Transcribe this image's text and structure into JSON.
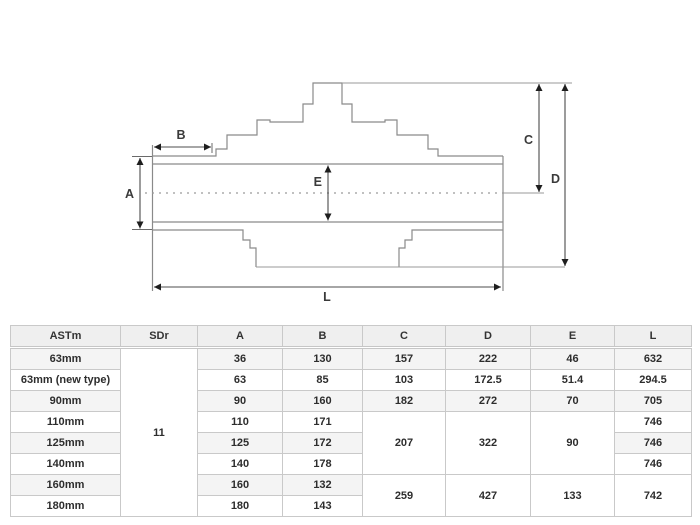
{
  "diagram": {
    "labels": {
      "A": "A",
      "B": "B",
      "C": "C",
      "D": "D",
      "E": "E",
      "L": "L"
    }
  },
  "table": {
    "headers": [
      "ASTm",
      "SDr",
      "A",
      "B",
      "C",
      "D",
      "E",
      "L"
    ],
    "sdr": {
      "value": "11",
      "rowspan": 8
    },
    "rows": [
      {
        "name": "63mm",
        "cells": [
          [
            "36"
          ],
          [
            "130"
          ],
          [
            "157"
          ],
          [
            "222"
          ],
          [
            "46"
          ],
          [
            "632"
          ]
        ]
      },
      {
        "name": "63mm (new type)",
        "cells": [
          [
            "63"
          ],
          [
            "85"
          ],
          [
            "103"
          ],
          [
            "172.5"
          ],
          [
            "51.4"
          ],
          [
            "294.5"
          ]
        ]
      },
      {
        "name": "90mm",
        "cells": [
          [
            "90"
          ],
          [
            "160"
          ],
          [
            "182"
          ],
          [
            "272"
          ],
          [
            "70"
          ],
          [
            "705"
          ]
        ]
      },
      {
        "name": "110mm",
        "cells": [
          [
            "110"
          ],
          [
            "171"
          ],
          [
            "207",
            3
          ],
          [
            "322",
            3
          ],
          [
            "90",
            3
          ],
          [
            "746"
          ]
        ]
      },
      {
        "name": "125mm",
        "cells": [
          [
            "125"
          ],
          [
            "172"
          ],
          [
            "746"
          ]
        ]
      },
      {
        "name": "140mm",
        "cells": [
          [
            "140"
          ],
          [
            "178"
          ],
          [
            "746"
          ]
        ]
      },
      {
        "name": "160mm",
        "cells": [
          [
            "160"
          ],
          [
            "132"
          ],
          [
            "259",
            2
          ],
          [
            "427",
            2
          ],
          [
            "133",
            2
          ],
          [
            "742",
            2
          ]
        ]
      },
      {
        "name": "180mm",
        "cells": [
          [
            "180"
          ],
          [
            "143"
          ]
        ]
      }
    ]
  }
}
